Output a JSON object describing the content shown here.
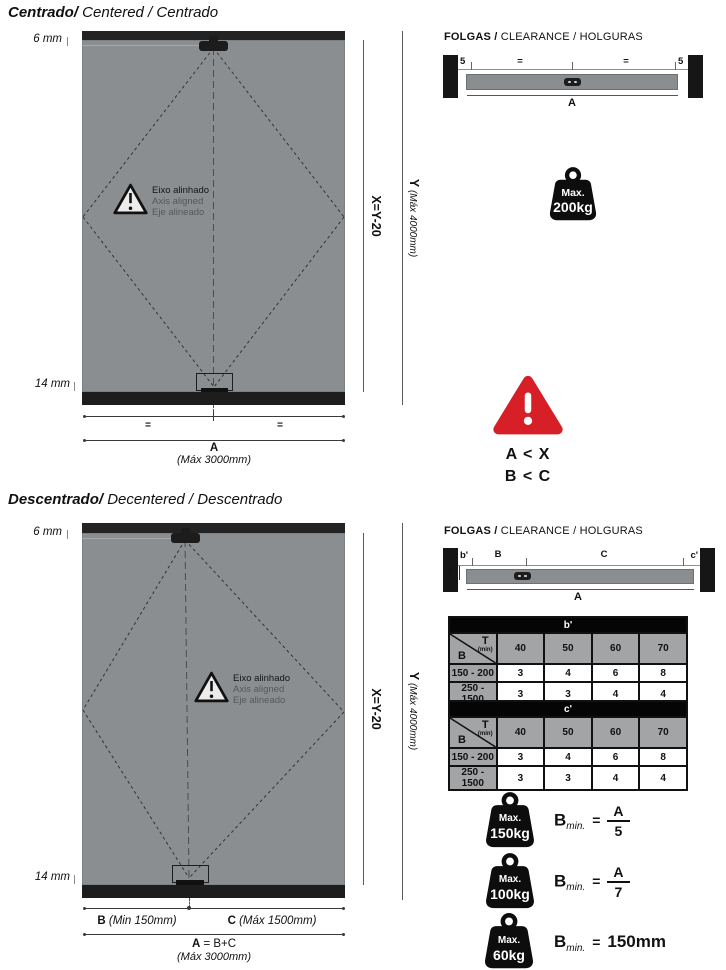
{
  "colors": {
    "panel": "#8b8e90",
    "bar": "#232323",
    "red": "#d61f26",
    "table_gray": "#a2a4a6"
  },
  "centered": {
    "title_main": "Centrado/",
    "title_rest": " Centered / Centrado",
    "gap_top": "6 mm",
    "gap_bottom": "14 mm",
    "axis_note": {
      "pt": "Eixo alinhado",
      "en": "Axis aligned",
      "es": "Eje alineado"
    },
    "x_label": "X=Y-20",
    "y_label": "Y",
    "y_note": " (Máx 4000mm)",
    "eq_left": "=",
    "eq_right": "=",
    "a_label": "A",
    "a_note": "(Máx 3000mm)"
  },
  "decentered": {
    "title_main": "Descentrado/",
    "title_rest": " Decentered / Descentrado",
    "gap_top": "6 mm",
    "gap_bottom": "14 mm",
    "axis_note": {
      "pt": "Eixo alinhado",
      "en": "Axis aligned",
      "es": "Eje alineado"
    },
    "x_label": "X=Y-20",
    "y_label": "Y",
    "y_note": " (Máx 4000mm)",
    "b_label": "B",
    "b_note": " (Min 150mm)",
    "c_label": "C",
    "c_note": " (Máx 1500mm)",
    "a_label": "A",
    "a_eq": " = B+C",
    "a_note": "(Máx 3000mm)"
  },
  "clearance_centered": {
    "title_main": "FOLGAS /",
    "title_rest": " CLEARANCE / HOLGURAS",
    "gap_left": "5",
    "gap_right": "5",
    "eq_left": "=",
    "eq_right": "=",
    "a_label": "A"
  },
  "clearance_decentered": {
    "title_main": "FOLGAS /",
    "title_rest": " CLEARANCE / HOLGURAS",
    "b_prime": "b'",
    "b": "B",
    "c": "C",
    "c_prime": "c'",
    "t": "T",
    "a_label": "A"
  },
  "max_weight": {
    "label": "Max.",
    "value": "200kg"
  },
  "warning": {
    "line1": "A < X",
    "line2": "B < C"
  },
  "tables": [
    {
      "title": "b'",
      "corner": {
        "t": "T",
        "min": "(min)",
        "b": "B"
      },
      "columns": [
        "40",
        "50",
        "60",
        "70"
      ],
      "rows": [
        {
          "label": "150 - 200",
          "values": [
            "3",
            "4",
            "6",
            "8"
          ]
        },
        {
          "label": "250 - 1500",
          "values": [
            "3",
            "3",
            "4",
            "4"
          ]
        }
      ]
    },
    {
      "title": "c'",
      "corner": {
        "t": "T",
        "min": "(min)",
        "b": "B"
      },
      "columns": [
        "40",
        "50",
        "60",
        "70"
      ],
      "rows": [
        {
          "label": "150 - 200",
          "values": [
            "3",
            "4",
            "6",
            "8"
          ]
        },
        {
          "label": "250 - 1500",
          "values": [
            "3",
            "3",
            "4",
            "4"
          ]
        }
      ]
    }
  ],
  "formulas": [
    {
      "weight_label": "Max.",
      "weight_value": "150kg",
      "b": "B",
      "sub": "min.",
      "eq": "=",
      "num": "A",
      "den": "5"
    },
    {
      "weight_label": "Max.",
      "weight_value": "100kg",
      "b": "B",
      "sub": "min.",
      "eq": "=",
      "num": "A",
      "den": "7"
    },
    {
      "weight_label": "Max.",
      "weight_value": "60kg",
      "b": "B",
      "sub": "min.",
      "eq": "=",
      "result": "150mm"
    }
  ]
}
